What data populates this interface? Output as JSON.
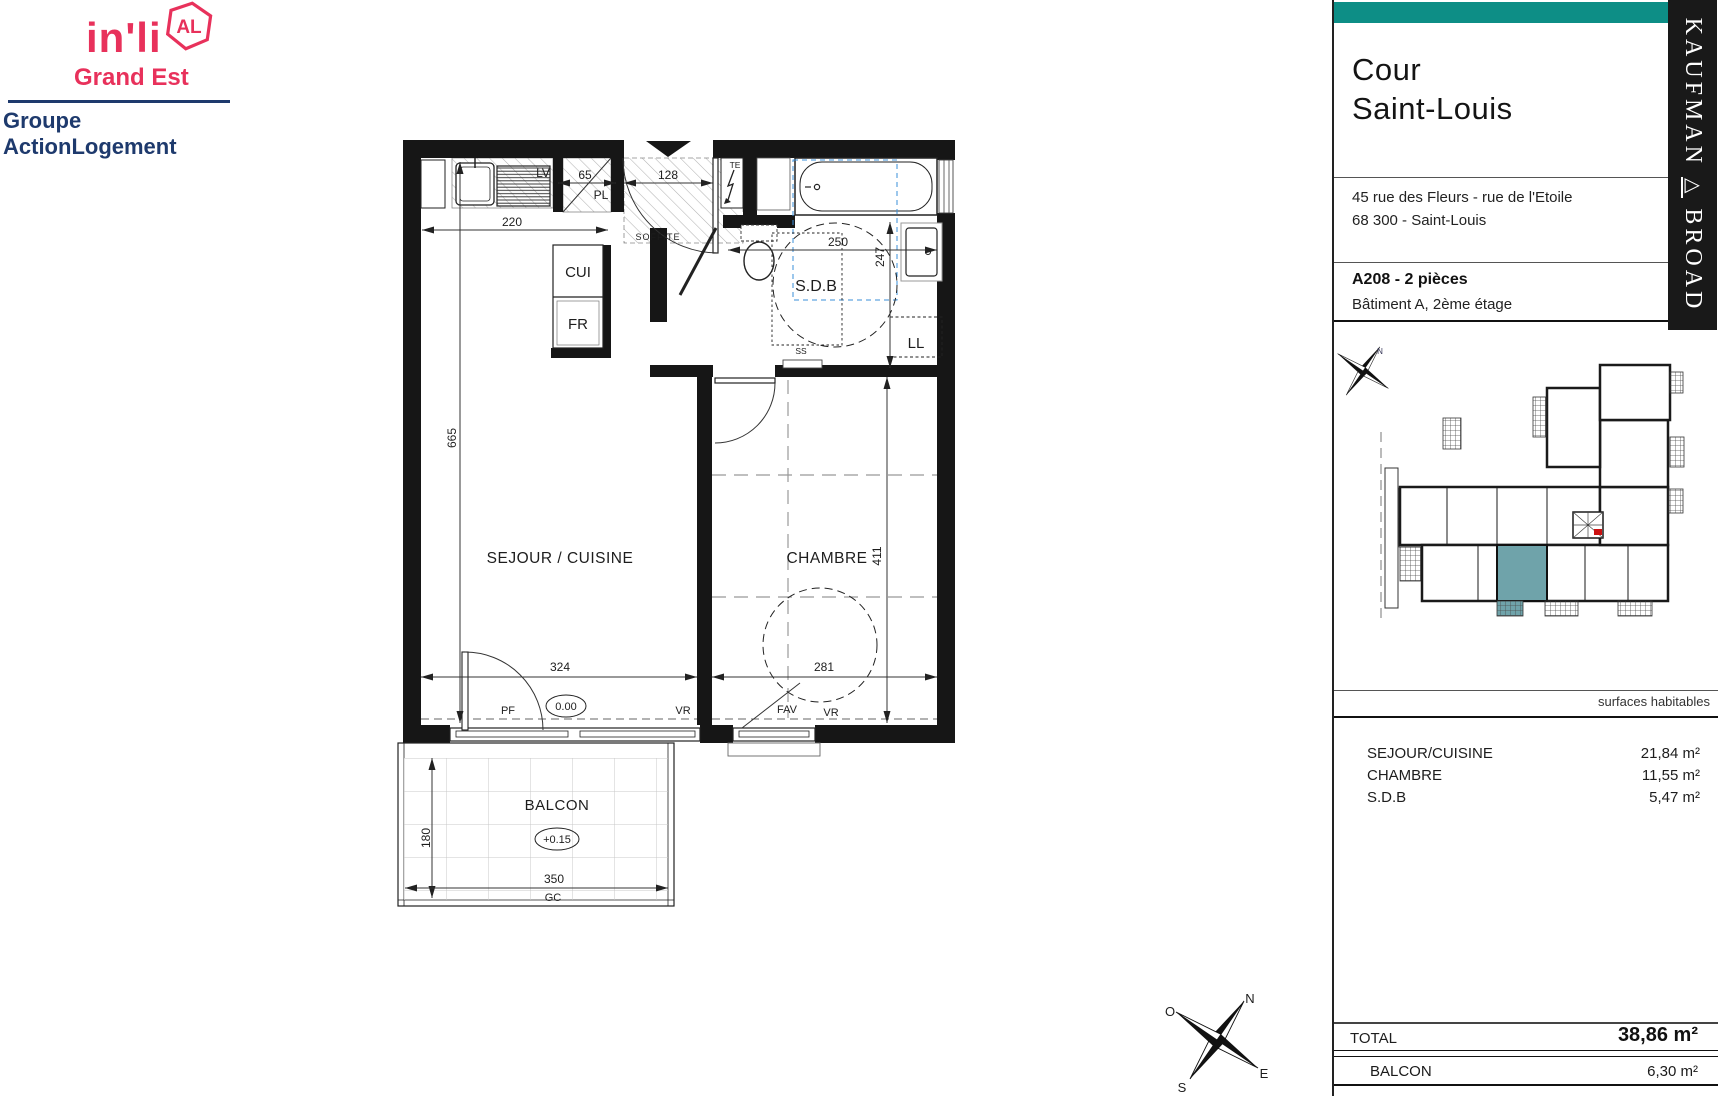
{
  "branding": {
    "name": "in'li",
    "badge": "AL",
    "region": "Grand Est",
    "group": "Groupe ActionLogement",
    "pink": "#e8315b",
    "navy": "#1e3a6d"
  },
  "sidebar": {
    "accent_color": "#0d8e86",
    "title_line1": "Cour",
    "title_line2": "Saint-Louis",
    "address_line1": "45 rue des Fleurs - rue de l'Etoile",
    "address_line2": "68 300 - Saint-Louis",
    "unit": "A208 - 2 pièces",
    "floor": "Bâtiment A,  2ème étage",
    "surfaces_header": "surfaces habitables",
    "rows": [
      {
        "label": "SEJOUR/CUISINE",
        "value": "21,84  m²"
      },
      {
        "label": "CHAMBRE",
        "value": "11,55  m²"
      },
      {
        "label": "S.D.B",
        "value": "5,47  m²"
      }
    ],
    "total_label": "TOTAL",
    "total_value": "38,86 m²",
    "balcony_label": "BALCON",
    "balcony_value": "6,30  m²",
    "site_plan": {
      "north_label": "N",
      "highlight_color": "#6fa3aa",
      "stair_marker_color": "#cc1111"
    }
  },
  "developer": {
    "name_left": "KAUFMAN",
    "separator": "△",
    "name_right": "BROAD"
  },
  "plan": {
    "rooms": {
      "living": "SEJOUR / CUISINE",
      "bedroom": "CHAMBRE",
      "bathroom": "S.D.B",
      "balcony": "BALCON"
    },
    "fixtures": {
      "lv": "LV",
      "pl": "PL",
      "te": "TE",
      "soffite": "SOFFITE",
      "cui": "CUI",
      "fr": "FR",
      "ll": "LL",
      "ss": "SS",
      "pf": "PF",
      "vr_left": "VR",
      "fav": "FAV",
      "vr_right": "VR",
      "gc": "GC"
    },
    "levels": {
      "floor": "0.00",
      "balcony": "+0.15"
    },
    "dims": {
      "kitchen_width": "220",
      "pl_width": "65",
      "entry_width": "128",
      "sdb_width": "250",
      "sdb_depth": "247",
      "living_height": "665",
      "bedroom_height": "411",
      "living_width": "324",
      "bedroom_width": "281",
      "balcony_depth": "180",
      "balcony_width": "350"
    }
  },
  "compass": {
    "n": "N",
    "e": "E",
    "s": "S",
    "o": "O"
  }
}
